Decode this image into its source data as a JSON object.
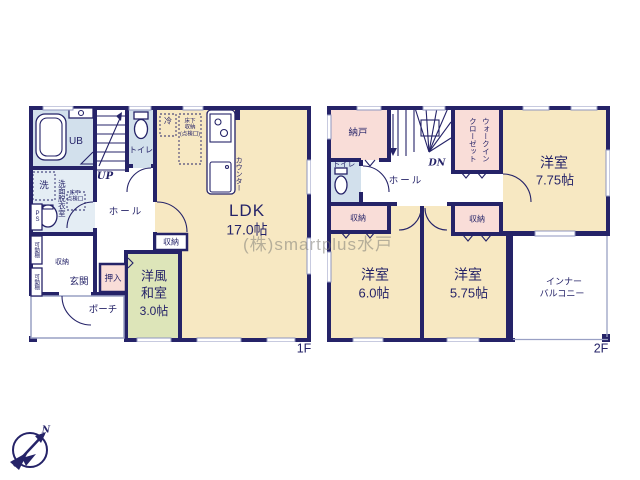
{
  "watermark": "(株)smartplus水戸",
  "compass": {
    "north": "N"
  },
  "floor1": {
    "floor_label": "1F",
    "ub": "UB",
    "toilet": "トイレ",
    "stairs_dir": "UP",
    "washer": "洗",
    "washroom": "洗面脱衣室",
    "hatch_l1": "床下",
    "hatch_l2": "点検口",
    "ps": "PS",
    "hall": "ホール",
    "fridge": "冷",
    "ufs_l1": "床下",
    "ufs_l2": "収納",
    "ufs_l3": "(点検口)",
    "counter": "カウンター",
    "ldk": "LDK",
    "ldk_size": "17.0帖",
    "storage_mid": "収納",
    "movable_upper": "可動棚",
    "movable_lower": "可動棚",
    "storage_left": "収納",
    "entrance": "玄関",
    "oshiire": "押入",
    "washitsu_l1": "洋風",
    "washitsu_l2": "和室",
    "washitsu_size": "3.0帖",
    "porch": "ポーチ"
  },
  "floor2": {
    "floor_label": "2F",
    "nando": "納戸",
    "stairs_dir": "DN",
    "wic_col1": "ウォークイン",
    "wic_col2": "クローゼット",
    "toilet": "トイレ",
    "hall": "ホール",
    "storage_left": "収納",
    "storage_mid": "収納",
    "room1": "洋室",
    "room1_size": "7.75帖",
    "room2": "洋室",
    "room2_size": "6.0帖",
    "room3": "洋室",
    "room3_size": "5.75帖",
    "balcony_l1": "インナー",
    "balcony_l2": "バルコニー"
  }
}
